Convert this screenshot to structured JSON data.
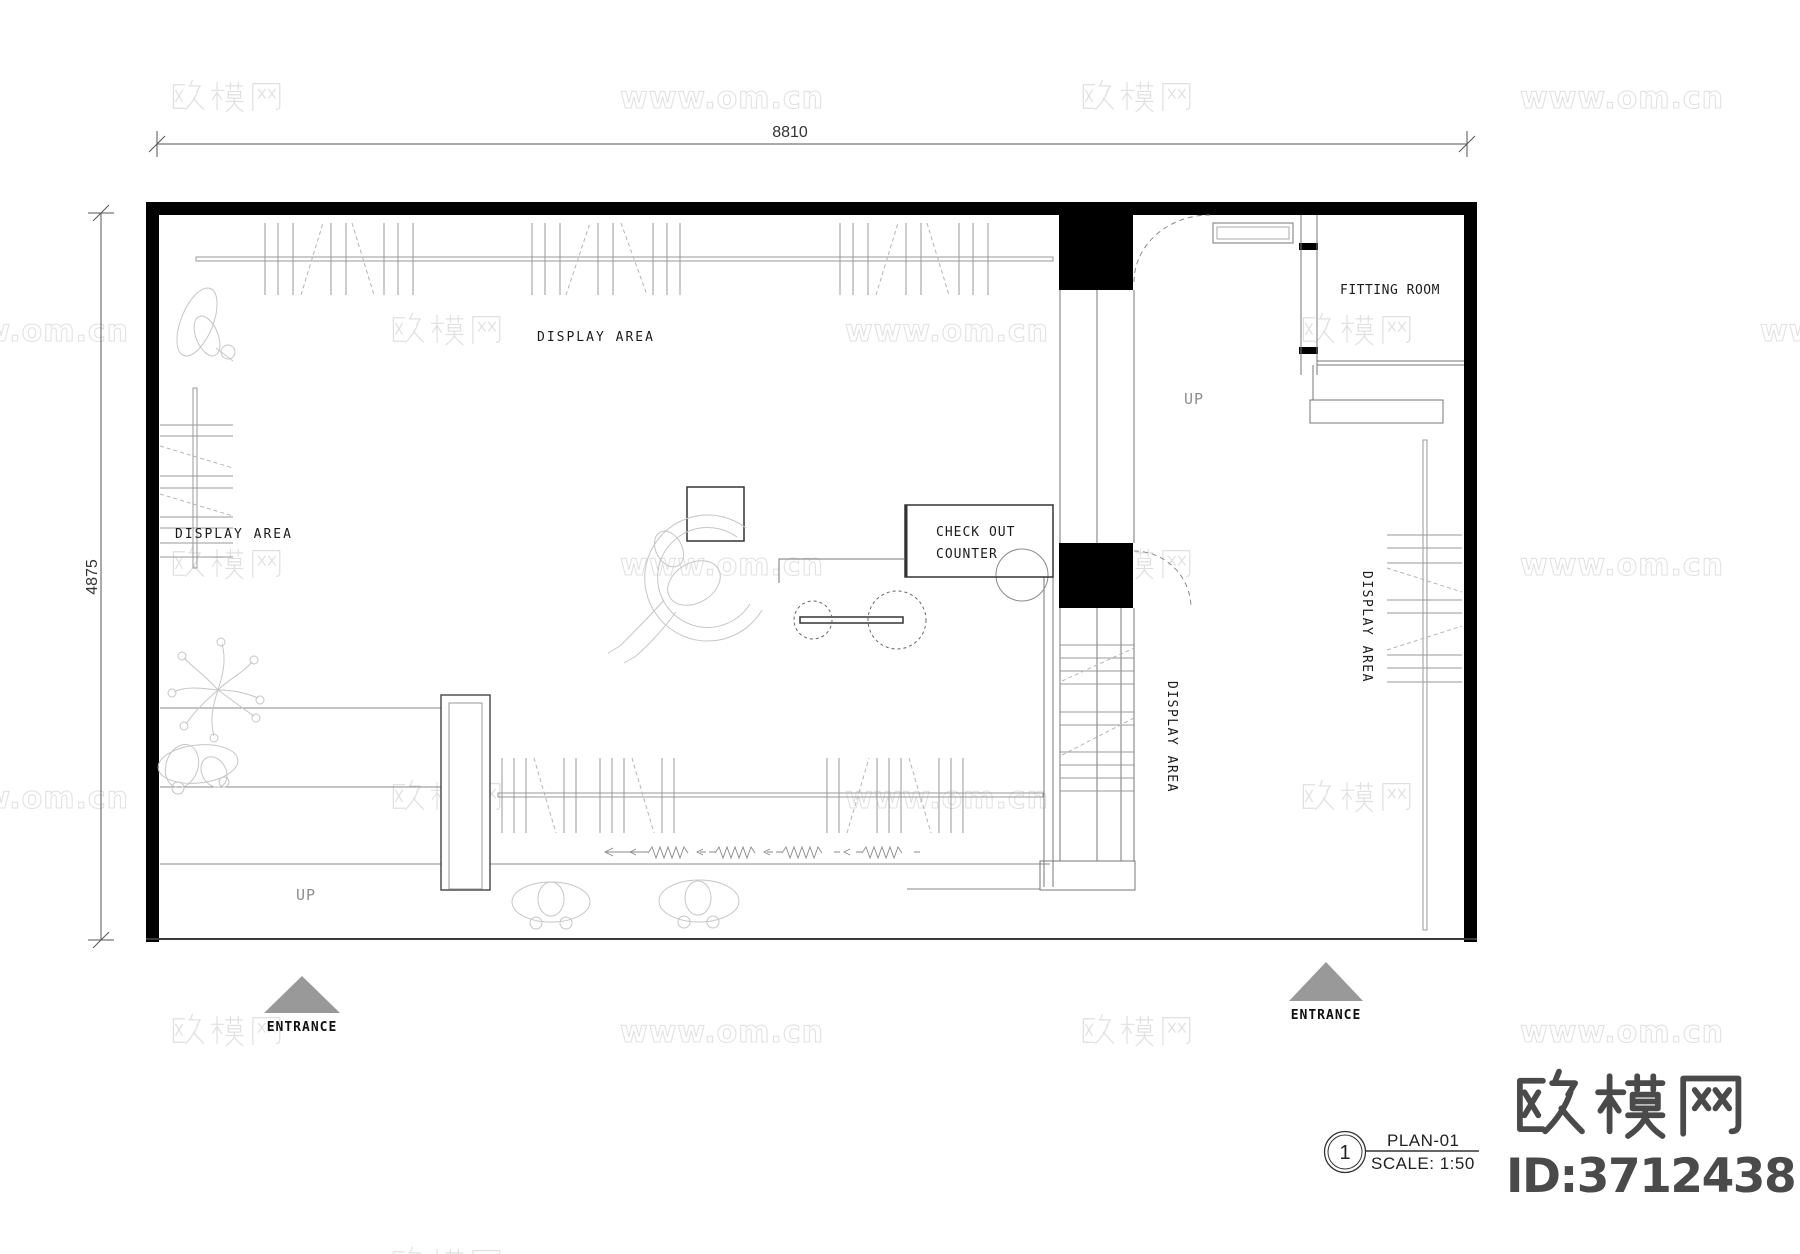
{
  "watermark": {
    "brand": "欧模网",
    "url": "www.om.cn"
  },
  "dimensions": {
    "width": "8810",
    "height": "4875"
  },
  "labels": {
    "display_area_top": "DISPLAY AREA",
    "display_area_left": "DISPLAY AREA",
    "display_area_stair": "DISPLAY AREA",
    "display_area_right": "DISPLAY AREA",
    "fitting_room": "FITTING ROOM",
    "checkout_line1": "CHECK OUT",
    "checkout_line2": "COUNTER",
    "up_upper": "UP",
    "up_lower": "UP",
    "entrance_left": "ENTRANCE",
    "entrance_right": "ENTRANCE"
  },
  "title_block": {
    "detail_number": "1",
    "drawing_name": "PLAN-01",
    "scale": "SCALE: 1:50"
  },
  "logo": {
    "brand": "欧模网",
    "model_id": "ID:3712438"
  }
}
